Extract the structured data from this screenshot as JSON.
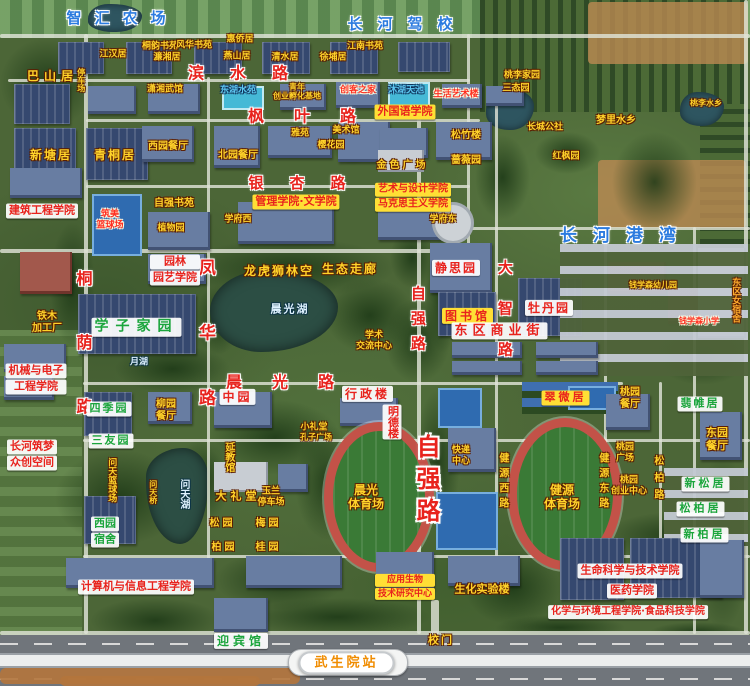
{
  "palette": {
    "road_label_red": "#e8231d",
    "place_yellow": "#ffd32a",
    "campus_blue": "#2b7bdf",
    "box_yellow": "#ffdf35",
    "box_white": "#ffffff",
    "green_label": "#1ba53c",
    "station_orange": "#f08c00",
    "water_blue": "#5ec8f2"
  },
  "map": {
    "labels": [
      {
        "t": "智汇农场",
        "x": 116,
        "y": 19,
        "k": "blue",
        "s": 15,
        "sp": 13
      },
      {
        "t": "长河驾校",
        "x": 400,
        "y": 25,
        "k": "blue",
        "s": 15,
        "sp": 15
      },
      {
        "t": "长河港湾",
        "x": 618,
        "y": 236,
        "k": "blue",
        "s": 17,
        "sp": 16
      },
      {
        "t": "滨水路",
        "x": 238,
        "y": 74,
        "k": "road",
        "s": 16,
        "sp": 26
      },
      {
        "t": "枫叶路",
        "x": 302,
        "y": 117,
        "k": "road",
        "s": 16,
        "sp": 30
      },
      {
        "t": "银杏路",
        "x": 297,
        "y": 184,
        "k": "road",
        "s": 15,
        "sp": 26
      },
      {
        "t": "晨光路",
        "x": 280,
        "y": 383,
        "k": "road",
        "s": 16,
        "sp": 30
      },
      {
        "t": "桐荫路",
        "x": 82,
        "y": 342,
        "k": "road",
        "s": 16,
        "sp": 48,
        "v": 1
      },
      {
        "t": "凤华路",
        "x": 205,
        "y": 332,
        "k": "road",
        "s": 17,
        "sp": 48,
        "v": 1
      },
      {
        "t": "自强路",
        "x": 417,
        "y": 318,
        "k": "road",
        "s": 15,
        "sp": 10,
        "v": 1
      },
      {
        "t": "自强路",
        "x": 426,
        "y": 478,
        "k": "roadBig",
        "s": 24,
        "sp": 8,
        "v": 1
      },
      {
        "t": "大智路",
        "x": 504,
        "y": 308,
        "k": "road",
        "s": 15,
        "sp": 26,
        "v": 1
      },
      {
        "t": "健源西路",
        "x": 502,
        "y": 480,
        "k": "yellow",
        "s": 10,
        "sp": 5,
        "v": 1
      },
      {
        "t": "健源东路",
        "x": 602,
        "y": 480,
        "k": "yellow",
        "s": 10,
        "sp": 5,
        "v": 1
      },
      {
        "t": "松柏路",
        "x": 657,
        "y": 477,
        "k": "yellow",
        "s": 10,
        "sp": 7,
        "v": 1
      },
      {
        "t": "桐韵书苑",
        "x": 160,
        "y": 47,
        "k": "yellow",
        "s": 9
      },
      {
        "t": "风华书苑",
        "x": 194,
        "y": 46,
        "k": "yellow",
        "s": 9
      },
      {
        "t": "惠侨居",
        "x": 240,
        "y": 40,
        "k": "yellow",
        "s": 9
      },
      {
        "t": "江汉居",
        "x": 113,
        "y": 55,
        "k": "yellow",
        "s": 9
      },
      {
        "t": "濂湘居",
        "x": 167,
        "y": 58,
        "k": "yellow",
        "s": 9
      },
      {
        "t": "燕山居",
        "x": 237,
        "y": 57,
        "k": "yellow",
        "s": 9
      },
      {
        "t": "清水居",
        "x": 285,
        "y": 58,
        "k": "yellow",
        "s": 9
      },
      {
        "t": "徐埔居",
        "x": 333,
        "y": 58,
        "k": "yellow",
        "s": 9
      },
      {
        "t": "江南书苑",
        "x": 365,
        "y": 47,
        "k": "yellow",
        "s": 9
      },
      {
        "t": "巴山居",
        "x": 50,
        "y": 76,
        "k": "yellow",
        "s": 12,
        "sp": 5
      },
      {
        "t": "停车场",
        "x": 81,
        "y": 80,
        "k": "yellow",
        "s": 8,
        "v": 1
      },
      {
        "t": "潇湘武馆",
        "x": 165,
        "y": 90,
        "k": "yellow",
        "s": 9
      },
      {
        "t": "东湖水苑",
        "x": 238,
        "y": 91,
        "k": "bluePlain",
        "s": 9
      },
      {
        "lines": [
          "青年",
          "创业孵化基地"
        ],
        "x": 297,
        "y": 92,
        "k": "yellow",
        "s": 8
      },
      {
        "t": "创客之家",
        "x": 358,
        "y": 91,
        "k": "redPlain",
        "s": 9
      },
      {
        "t": "沐湖天池",
        "x": 406,
        "y": 91,
        "k": "bluePlain",
        "s": 9
      },
      {
        "t": "生活艺术楼",
        "x": 456,
        "y": 95,
        "k": "redPlain",
        "s": 9
      },
      {
        "t": "桃李家园",
        "x": 522,
        "y": 76,
        "k": "yellow",
        "s": 9
      },
      {
        "t": "三态园",
        "x": 516,
        "y": 89,
        "k": "yellow",
        "s": 9
      },
      {
        "t": "桃李水乡",
        "x": 706,
        "y": 103,
        "k": "yellow",
        "s": 8
      },
      {
        "t": "梦里水乡",
        "x": 616,
        "y": 121,
        "k": "yellow",
        "s": 10
      },
      {
        "t": "长城公社",
        "x": 545,
        "y": 128,
        "k": "yellow",
        "s": 9
      },
      {
        "t": "红枫园",
        "x": 566,
        "y": 157,
        "k": "yellow",
        "s": 9
      },
      {
        "t": "新塘居",
        "x": 50,
        "y": 155,
        "k": "yellow",
        "s": 12,
        "sp": 2
      },
      {
        "t": "青桐居",
        "x": 114,
        "y": 155,
        "k": "yellow",
        "s": 12,
        "sp": 2
      },
      {
        "t": "西园餐厅",
        "x": 168,
        "y": 147,
        "k": "yellow",
        "s": 10
      },
      {
        "t": "北园餐厅",
        "x": 238,
        "y": 156,
        "k": "yellow",
        "s": 10
      },
      {
        "t": "雅苑",
        "x": 300,
        "y": 134,
        "k": "yellow",
        "s": 9
      },
      {
        "t": "美术馆",
        "x": 346,
        "y": 131,
        "k": "yellow",
        "s": 9
      },
      {
        "t": "樱花园",
        "x": 331,
        "y": 146,
        "k": "yellow",
        "s": 9
      },
      {
        "t": "松竹楼",
        "x": 466,
        "y": 136,
        "k": "yellow",
        "s": 10
      },
      {
        "t": "蔷薇园",
        "x": 466,
        "y": 161,
        "k": "yellow",
        "s": 10
      },
      {
        "t": "金色广场",
        "x": 401,
        "y": 166,
        "k": "yellow",
        "s": 10,
        "sp": 3
      },
      {
        "t": "外国语学院",
        "x": 405,
        "y": 112,
        "k": "redYellow",
        "s": 11
      },
      {
        "t": "管理学院·文学院",
        "x": 296,
        "y": 202,
        "k": "redYellow",
        "s": 11
      },
      {
        "lines": [
          "艺术与设计学院",
          "马克思主义学院"
        ],
        "x": 413,
        "y": 197,
        "k": "redYellow",
        "s": 10
      },
      {
        "t": "建筑工程学院",
        "x": 42,
        "y": 211,
        "k": "redWhite",
        "s": 11
      },
      {
        "lines": [
          "筑美",
          "篮球场"
        ],
        "x": 110,
        "y": 220,
        "k": "redPlain",
        "s": 9
      },
      {
        "t": "自强书苑",
        "x": 174,
        "y": 204,
        "k": "yellow",
        "s": 10
      },
      {
        "t": "植物园",
        "x": 171,
        "y": 229,
        "k": "yellow",
        "s": 9
      },
      {
        "t": "学府西",
        "x": 238,
        "y": 220,
        "k": "yellow",
        "s": 9
      },
      {
        "t": "学府东",
        "x": 443,
        "y": 220,
        "k": "yellow",
        "s": 9
      },
      {
        "lines": [
          "园林",
          "园艺学院"
        ],
        "x": 175,
        "y": 270,
        "k": "redWhite",
        "s": 11
      },
      {
        "t": "龙虎狮林空",
        "x": 278,
        "y": 271,
        "k": "yellow",
        "s": 12,
        "sp": 2
      },
      {
        "t": "生态走廊",
        "x": 349,
        "y": 269,
        "k": "yellow",
        "s": 12,
        "sp": 2
      },
      {
        "t": "静思园",
        "x": 455,
        "y": 268,
        "k": "redWhite",
        "s": 12,
        "sp": 2
      },
      {
        "t": "晨光湖",
        "x": 289,
        "y": 310,
        "k": "lake",
        "s": 11,
        "sp": 2
      },
      {
        "lines": [
          "学术",
          "交流中心"
        ],
        "x": 374,
        "y": 341,
        "k": "yellow",
        "s": 9
      },
      {
        "t": "图书馆",
        "x": 466,
        "y": 316,
        "k": "redYellow",
        "s": 12,
        "sp": 3
      },
      {
        "t": "牡丹园",
        "x": 548,
        "y": 308,
        "k": "redWhite",
        "s": 12,
        "sp": 2
      },
      {
        "t": "钱学森幼儿园",
        "x": 653,
        "y": 285,
        "k": "yellow",
        "s": 8
      },
      {
        "t": "钱学森小学",
        "x": 699,
        "y": 321,
        "k": "redPlain",
        "s": 8
      },
      {
        "t": "东区女宿舍",
        "x": 735,
        "y": 300,
        "k": "orange",
        "s": 9,
        "v": 1
      },
      {
        "t": "东区商业街",
        "x": 497,
        "y": 331,
        "k": "redWhite",
        "s": 13,
        "sp": 5
      },
      {
        "t": "学子家园",
        "x": 133,
        "y": 327,
        "k": "greenWhite",
        "s": 14,
        "sp": 7
      },
      {
        "lines": [
          "铁木",
          "加工厂"
        ],
        "x": 47,
        "y": 323,
        "k": "yellow",
        "s": 10
      },
      {
        "t": "月湖",
        "x": 139,
        "y": 363,
        "k": "lake",
        "s": 9
      },
      {
        "lines": [
          "机械与电子",
          "工程学院"
        ],
        "x": 36,
        "y": 379,
        "k": "redWhite",
        "s": 11
      },
      {
        "t": "四季园",
        "x": 108,
        "y": 409,
        "k": "greenWhite",
        "s": 11,
        "sp": 2
      },
      {
        "t": "三友园",
        "x": 110,
        "y": 441,
        "k": "greenWhite",
        "s": 11,
        "sp": 2
      },
      {
        "lines": [
          "柳园",
          "餐厅"
        ],
        "x": 166,
        "y": 411,
        "k": "yellow",
        "s": 10
      },
      {
        "lines": [
          "长河筑梦",
          "众创空间"
        ],
        "x": 32,
        "y": 455,
        "k": "redWhite",
        "s": 11
      },
      {
        "t": "中园",
        "x": 236,
        "y": 397,
        "k": "redWhite",
        "s": 12,
        "sp": 3
      },
      {
        "t": "行政楼",
        "x": 366,
        "y": 394,
        "k": "redWhite",
        "s": 12,
        "sp": 3
      },
      {
        "t": "明德楼",
        "x": 392,
        "y": 422,
        "k": "redWhite",
        "s": 11,
        "v": 1
      },
      {
        "t": "小礼堂",
        "x": 314,
        "y": 428,
        "k": "yellow",
        "s": 9
      },
      {
        "t": "孔子广场",
        "x": 316,
        "y": 437,
        "k": "yellow",
        "s": 8
      },
      {
        "t": "延教馆",
        "x": 228,
        "y": 457,
        "k": "yellow",
        "s": 10,
        "v": 1
      },
      {
        "t": "问天篮球场",
        "x": 111,
        "y": 480,
        "k": "yellow",
        "s": 9,
        "v": 1
      },
      {
        "t": "问天桥",
        "x": 153,
        "y": 492,
        "k": "yellow",
        "s": 8,
        "v": 1
      },
      {
        "t": "问天湖",
        "x": 183,
        "y": 494,
        "k": "lake",
        "s": 10,
        "v": 1
      },
      {
        "t": "翠微居",
        "x": 564,
        "y": 398,
        "k": "redYellow",
        "s": 11,
        "sp": 3
      },
      {
        "lines": [
          "快递",
          "中心"
        ],
        "x": 461,
        "y": 456,
        "k": "yellow",
        "s": 9
      },
      {
        "lines": [
          "晨光",
          "体育场"
        ],
        "x": 366,
        "y": 497,
        "k": "yellow",
        "s": 12
      },
      {
        "lines": [
          "健源",
          "体育场"
        ],
        "x": 562,
        "y": 497,
        "k": "yellow",
        "s": 12
      },
      {
        "t": "大礼堂",
        "x": 236,
        "y": 497,
        "k": "yellow",
        "s": 11,
        "sp": 4
      },
      {
        "lines": [
          "玉兰",
          "停车场"
        ],
        "x": 271,
        "y": 497,
        "k": "yellow",
        "s": 9
      },
      {
        "lines": [
          "西园",
          "宿舍"
        ],
        "x": 105,
        "y": 532,
        "k": "greenWhite",
        "s": 11
      },
      {
        "t": "松园",
        "x": 221,
        "y": 524,
        "k": "yellow",
        "s": 10,
        "sp": 3
      },
      {
        "t": "梅园",
        "x": 267,
        "y": 524,
        "k": "yellow",
        "s": 10,
        "sp": 3
      },
      {
        "t": "柏园",
        "x": 223,
        "y": 548,
        "k": "yellow",
        "s": 10,
        "sp": 3
      },
      {
        "t": "桂园",
        "x": 267,
        "y": 548,
        "k": "yellow",
        "s": 10,
        "sp": 3
      },
      {
        "lines": [
          "桃园",
          "餐厅"
        ],
        "x": 630,
        "y": 399,
        "k": "yellow",
        "s": 10
      },
      {
        "t": "翡帷居",
        "x": 699,
        "y": 404,
        "k": "greenWhite",
        "s": 11,
        "sp": 2
      },
      {
        "lines": [
          "桃园",
          "广场"
        ],
        "x": 625,
        "y": 453,
        "k": "yellow",
        "s": 9
      },
      {
        "lines": [
          "桃园",
          "创业中心"
        ],
        "x": 629,
        "y": 486,
        "k": "yellow",
        "s": 9
      },
      {
        "lines": [
          "东园",
          "餐厅"
        ],
        "x": 717,
        "y": 440,
        "k": "yellow",
        "s": 11
      },
      {
        "t": "新松居",
        "x": 704,
        "y": 484,
        "k": "greenWhite",
        "s": 11,
        "sp": 3
      },
      {
        "t": "松柏居",
        "x": 699,
        "y": 509,
        "k": "greenWhite",
        "s": 11,
        "sp": 3
      },
      {
        "t": "新柏居",
        "x": 703,
        "y": 535,
        "k": "greenWhite",
        "s": 11,
        "sp": 3
      },
      {
        "t": "计算机与信息工程学院",
        "x": 136,
        "y": 587,
        "k": "redWhite",
        "s": 11
      },
      {
        "lines": [
          "应用生物",
          "技术研究中心"
        ],
        "x": 405,
        "y": 587,
        "k": "redYellow",
        "s": 9
      },
      {
        "t": "生化实验楼",
        "x": 482,
        "y": 590,
        "k": "yellow",
        "s": 11
      },
      {
        "t": "生命科学与技术学院",
        "x": 630,
        "y": 571,
        "k": "redWhite",
        "s": 11
      },
      {
        "t": "医药学院",
        "x": 632,
        "y": 591,
        "k": "redWhite",
        "s": 11
      },
      {
        "t": "化学与环境工程学院·食品科技学院",
        "x": 628,
        "y": 612,
        "k": "redWhite",
        "s": 10
      },
      {
        "t": "迎宾馆",
        "x": 239,
        "y": 641,
        "k": "greenWhite",
        "s": 12,
        "sp": 4
      },
      {
        "t": "校门",
        "x": 440,
        "y": 641,
        "k": "yellow",
        "s": 11,
        "sp": 2
      },
      {
        "t": "武生院站",
        "x": 345,
        "y": 663,
        "k": "station",
        "s": 13,
        "sp": 3,
        "n": "station-badge"
      }
    ]
  }
}
